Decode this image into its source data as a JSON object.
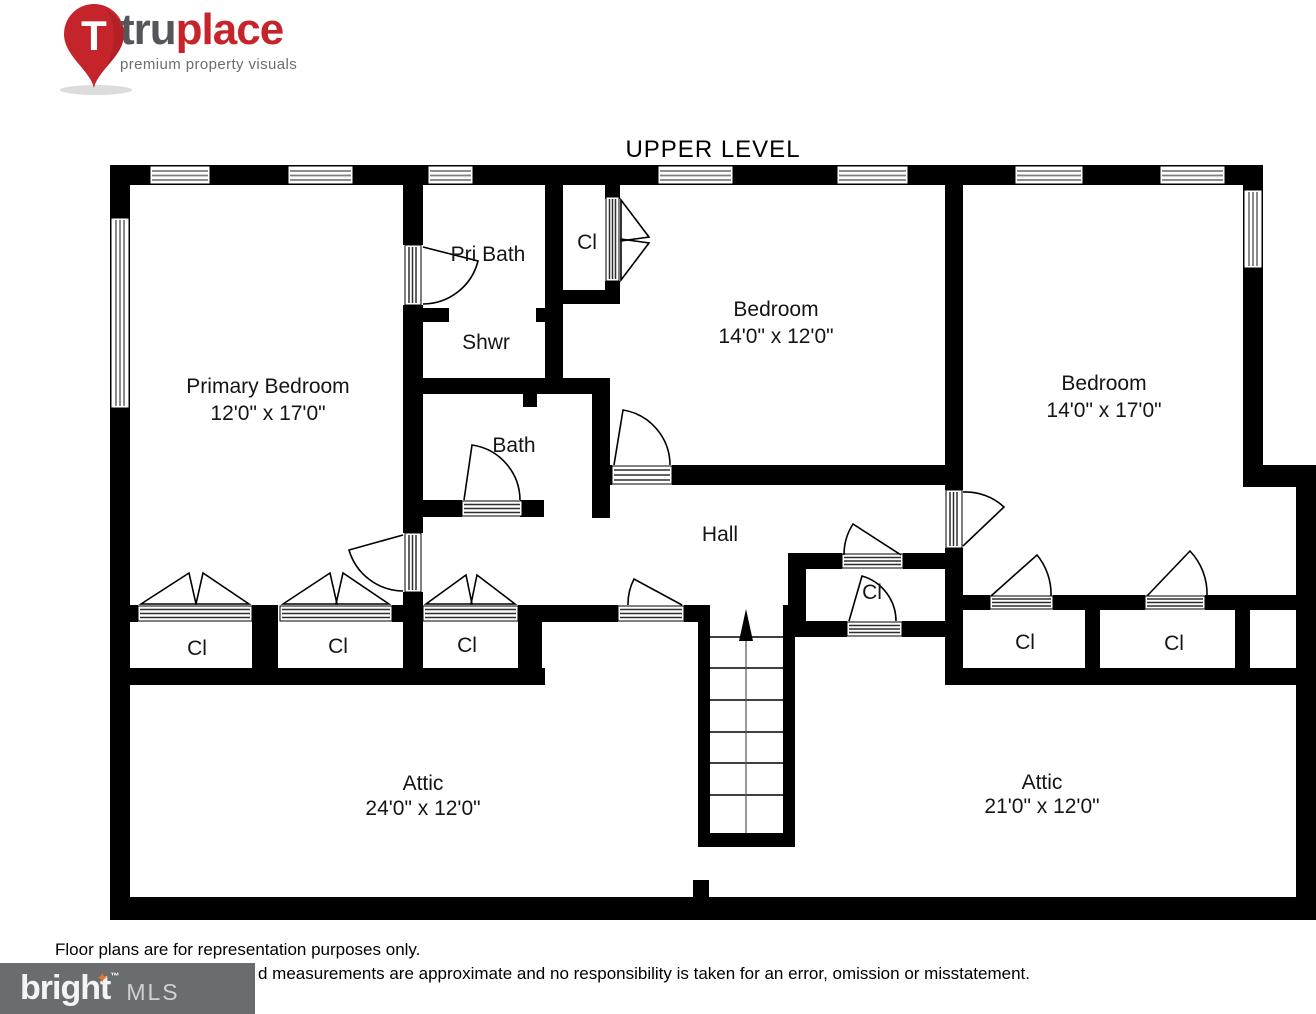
{
  "logo": {
    "pin_letter": "T",
    "brand_tru": "tru",
    "brand_place": "place",
    "tagline": "premium property visuals"
  },
  "title": "UPPER LEVEL",
  "rooms": {
    "primary_bedroom": {
      "name": "Primary Bedroom",
      "dims": "12'0\" x 17'0\""
    },
    "pri_bath": {
      "name": "Pri Bath"
    },
    "shwr": {
      "name": "Shwr"
    },
    "cl_top": {
      "name": "Cl"
    },
    "bedroom_mid": {
      "name": "Bedroom",
      "dims": "14'0\" x 12'0\""
    },
    "bedroom_right": {
      "name": "Bedroom",
      "dims": "14'0\" x 17'0\""
    },
    "bath": {
      "name": "Bath"
    },
    "hall": {
      "name": "Hall"
    },
    "cl_mid": {
      "name": "Cl"
    },
    "cl_left_1": {
      "name": "Cl"
    },
    "cl_left_2": {
      "name": "Cl"
    },
    "cl_left_3": {
      "name": "Cl"
    },
    "cl_right_1": {
      "name": "Cl"
    },
    "cl_right_2": {
      "name": "Cl"
    },
    "attic_left": {
      "name": "Attic",
      "dims": "24'0\" x 12'0\""
    },
    "attic_right": {
      "name": "Attic",
      "dims": "21'0\" x 12'0\""
    }
  },
  "footer": {
    "line1": "Floor plans are for representation purposes only.",
    "line2": "d measurements are approximate and no responsibility is taken for an error, omission or misstatement."
  },
  "mls": {
    "brand": "bright",
    "tm": "™",
    "star_glyph": "✦",
    "suffix": "MLS"
  }
}
